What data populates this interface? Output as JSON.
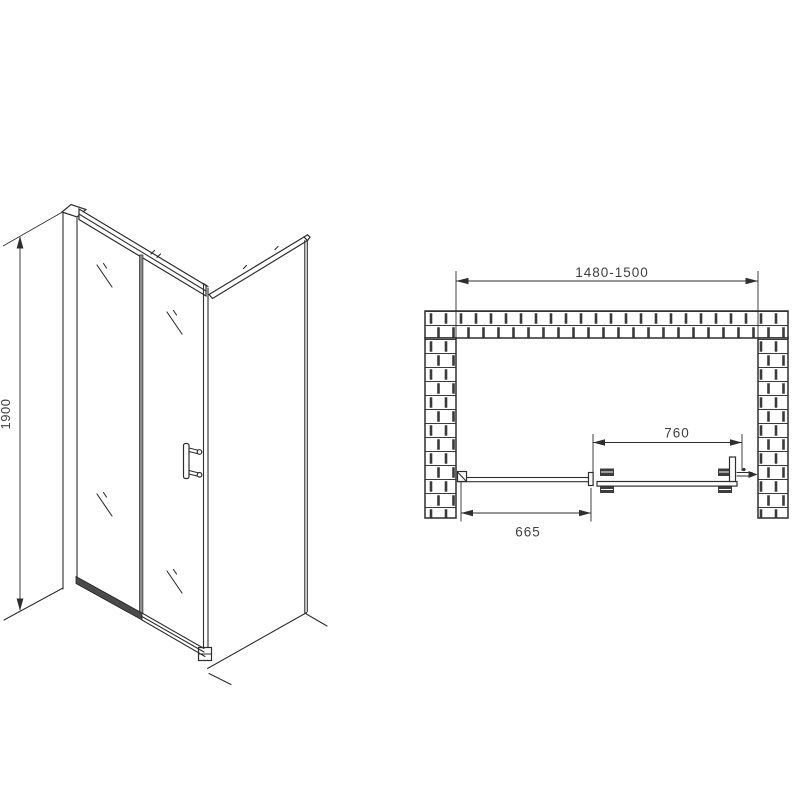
{
  "title": "Sliding shower door installation drawing",
  "views": {
    "isometric": {
      "name": "front-isometric-view"
    },
    "plan": {
      "name": "top-plan-view"
    }
  },
  "dimensions": {
    "height": "1900",
    "niche_width": "1480-1500",
    "sliding_panel": "760",
    "fixed_panel": "665"
  },
  "colors": {
    "line": "#2e2e2e",
    "dim_text": "#3f3f3f",
    "track_dark": "#4a4a4a",
    "background": "#ffffff"
  }
}
